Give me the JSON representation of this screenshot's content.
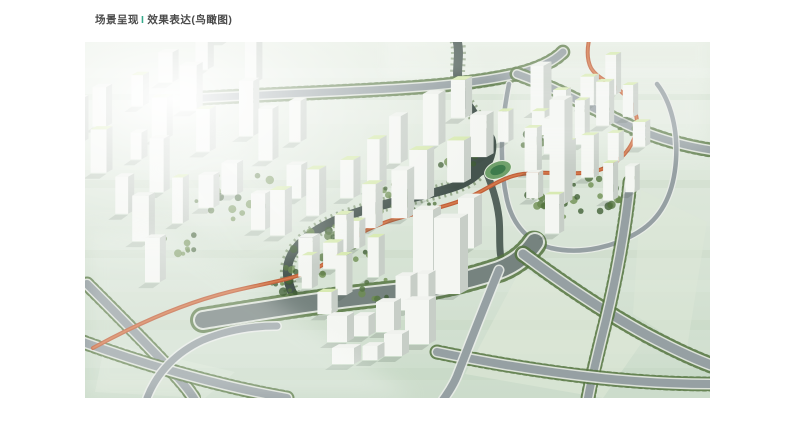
{
  "header": {
    "title_prefix": "场景呈现",
    "separator": "I",
    "title_suffix": "效果表达(鸟瞰图)",
    "text_color": "#4b4b4b",
    "separator_color": "#35a98a"
  },
  "scene": {
    "description": "城市滨水片区设计鸟瞰效果图：白色高层住宅塔楼群、浅绿色屋顶、深色河道、灰色道路网、行道树与橙色景观绿道",
    "colors": {
      "ground_top": "#e7eee4",
      "ground_bottom": "#ccdccb",
      "ground_streak": "#b7cdb3",
      "road_fill": "#96a0a3",
      "road_casing": "#e9ece8",
      "road_dark": "#76837f",
      "water": "#45544e",
      "bank_green": "#4e6b3c",
      "tree_dark": "#3f5e33",
      "tree_mid": "#55743f",
      "tree_light": "#6d8d50",
      "building_face": "#f4f6f2",
      "building_side": "#c7cec7",
      "building_shadow": "#3e4c44",
      "roof_green": "#d8eab2",
      "roof_pale": "#eef1ec",
      "greenway": "#c0603a",
      "greenway_hi": "#d97f4f",
      "fog": "#ffffff",
      "stadium_field": "#3e7b4c",
      "stadium_track": "#6fa06a",
      "text_color": "#4b4b4b",
      "separator_color": "#35a98a"
    },
    "clusters": [
      {
        "id": "west",
        "seed": 11,
        "cx": 112,
        "cy": 122,
        "rot": -32,
        "rows": 5,
        "cols": 6,
        "sx": 37,
        "sy": 42,
        "jitter": 9,
        "w": 13,
        "dp": 6,
        "hmin": 26,
        "hmax": 56,
        "skip": 0.12,
        "roof_green_chance": 0.3
      },
      {
        "id": "central",
        "seed": 7,
        "cx": 298,
        "cy": 156,
        "rot": -33,
        "rows": 2,
        "cols": 7,
        "sx": 34,
        "sy": 40,
        "jitter": 7,
        "w": 14,
        "dp": 7,
        "hmin": 30,
        "hmax": 52,
        "skip": 0.08,
        "roof_green_chance": 0.85
      },
      {
        "id": "central-south",
        "seed": 5,
        "cx": 252,
        "cy": 242,
        "rot": -33,
        "rows": 2,
        "cols": 3,
        "sx": 30,
        "sy": 32,
        "jitter": 6,
        "w": 12,
        "dp": 6,
        "hmin": 22,
        "hmax": 40,
        "skip": 0.1,
        "roof_green_chance": 0.8
      },
      {
        "id": "east",
        "seed": 23,
        "cx": 498,
        "cy": 116,
        "rot": -28,
        "rows": 4,
        "cols": 5,
        "sx": 29,
        "sy": 31,
        "jitter": 6,
        "w": 11,
        "dp": 5,
        "hmin": 24,
        "hmax": 46,
        "skip": 0.15,
        "roof_green_chance": 0.9
      }
    ],
    "landmark_towers": [
      [
        338,
        232,
        20,
        64
      ],
      [
        362,
        252,
        26,
        76
      ],
      [
        381,
        206,
        16,
        50
      ],
      [
        472,
        162,
        15,
        104
      ],
      [
        452,
        70,
        13,
        46
      ]
    ],
    "lowrise_blocks": [
      [
        252,
        300,
        20,
        26
      ],
      [
        276,
        294,
        15,
        20
      ],
      [
        300,
        290,
        18,
        30
      ],
      [
        258,
        322,
        22,
        16
      ],
      [
        285,
        318,
        15,
        14
      ],
      [
        308,
        314,
        18,
        22
      ],
      [
        332,
        302,
        24,
        44
      ],
      [
        318,
        268,
        15,
        34
      ],
      [
        337,
        260,
        13,
        28
      ]
    ],
    "tree_patches": [
      [
        250,
        205,
        45,
        22,
        30
      ],
      [
        320,
        158,
        40,
        18,
        24
      ],
      [
        215,
        238,
        30,
        15,
        16
      ],
      [
        490,
        152,
        50,
        24,
        34
      ],
      [
        455,
        98,
        20,
        10,
        10
      ],
      [
        148,
        152,
        45,
        25,
        16
      ],
      [
        92,
        200,
        30,
        15,
        10
      ],
      [
        540,
        88,
        18,
        9,
        8
      ],
      [
        292,
        248,
        28,
        14,
        12
      ],
      [
        372,
        118,
        22,
        10,
        10
      ]
    ]
  }
}
